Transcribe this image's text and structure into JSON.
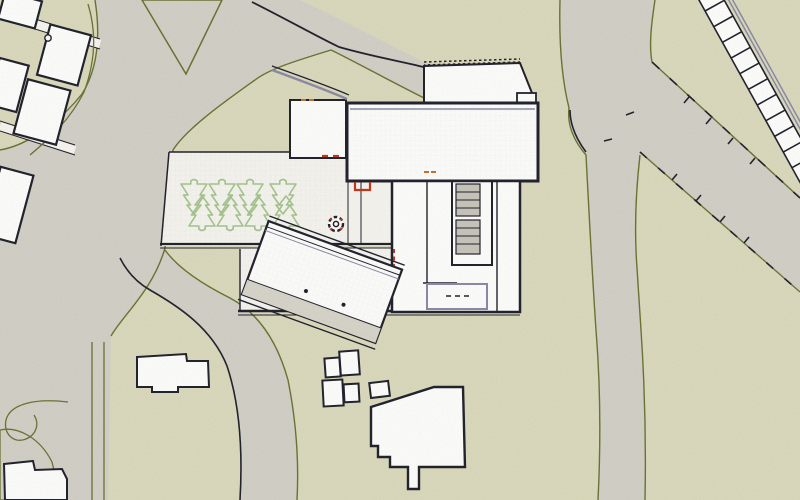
{
  "image": {
    "type": "architectural-site-plan",
    "width": 800,
    "height": 500
  },
  "palette": {
    "parcel": "#dcdabd",
    "road": "#d3d0c7",
    "lane": "#f6f5f0",
    "building": "#fdfdfb",
    "plaza": "#f5f4ee",
    "outline": "#23232e",
    "wall_accent": "#8b8ba6",
    "parcel_line": "#6b7434",
    "tree": "#a6c48e",
    "accent_red": "#c0391f",
    "accent_orange": "#c9702e",
    "stair": "#c8c5bb",
    "roof_band": "#d8d5ca"
  },
  "features": {
    "terrace_trees": 8,
    "parking_strip_cells": 12,
    "houses_northwest": 5,
    "outbuildings_south": 6,
    "stair_flights_courtyard": 2,
    "planter_symbols": 1
  }
}
